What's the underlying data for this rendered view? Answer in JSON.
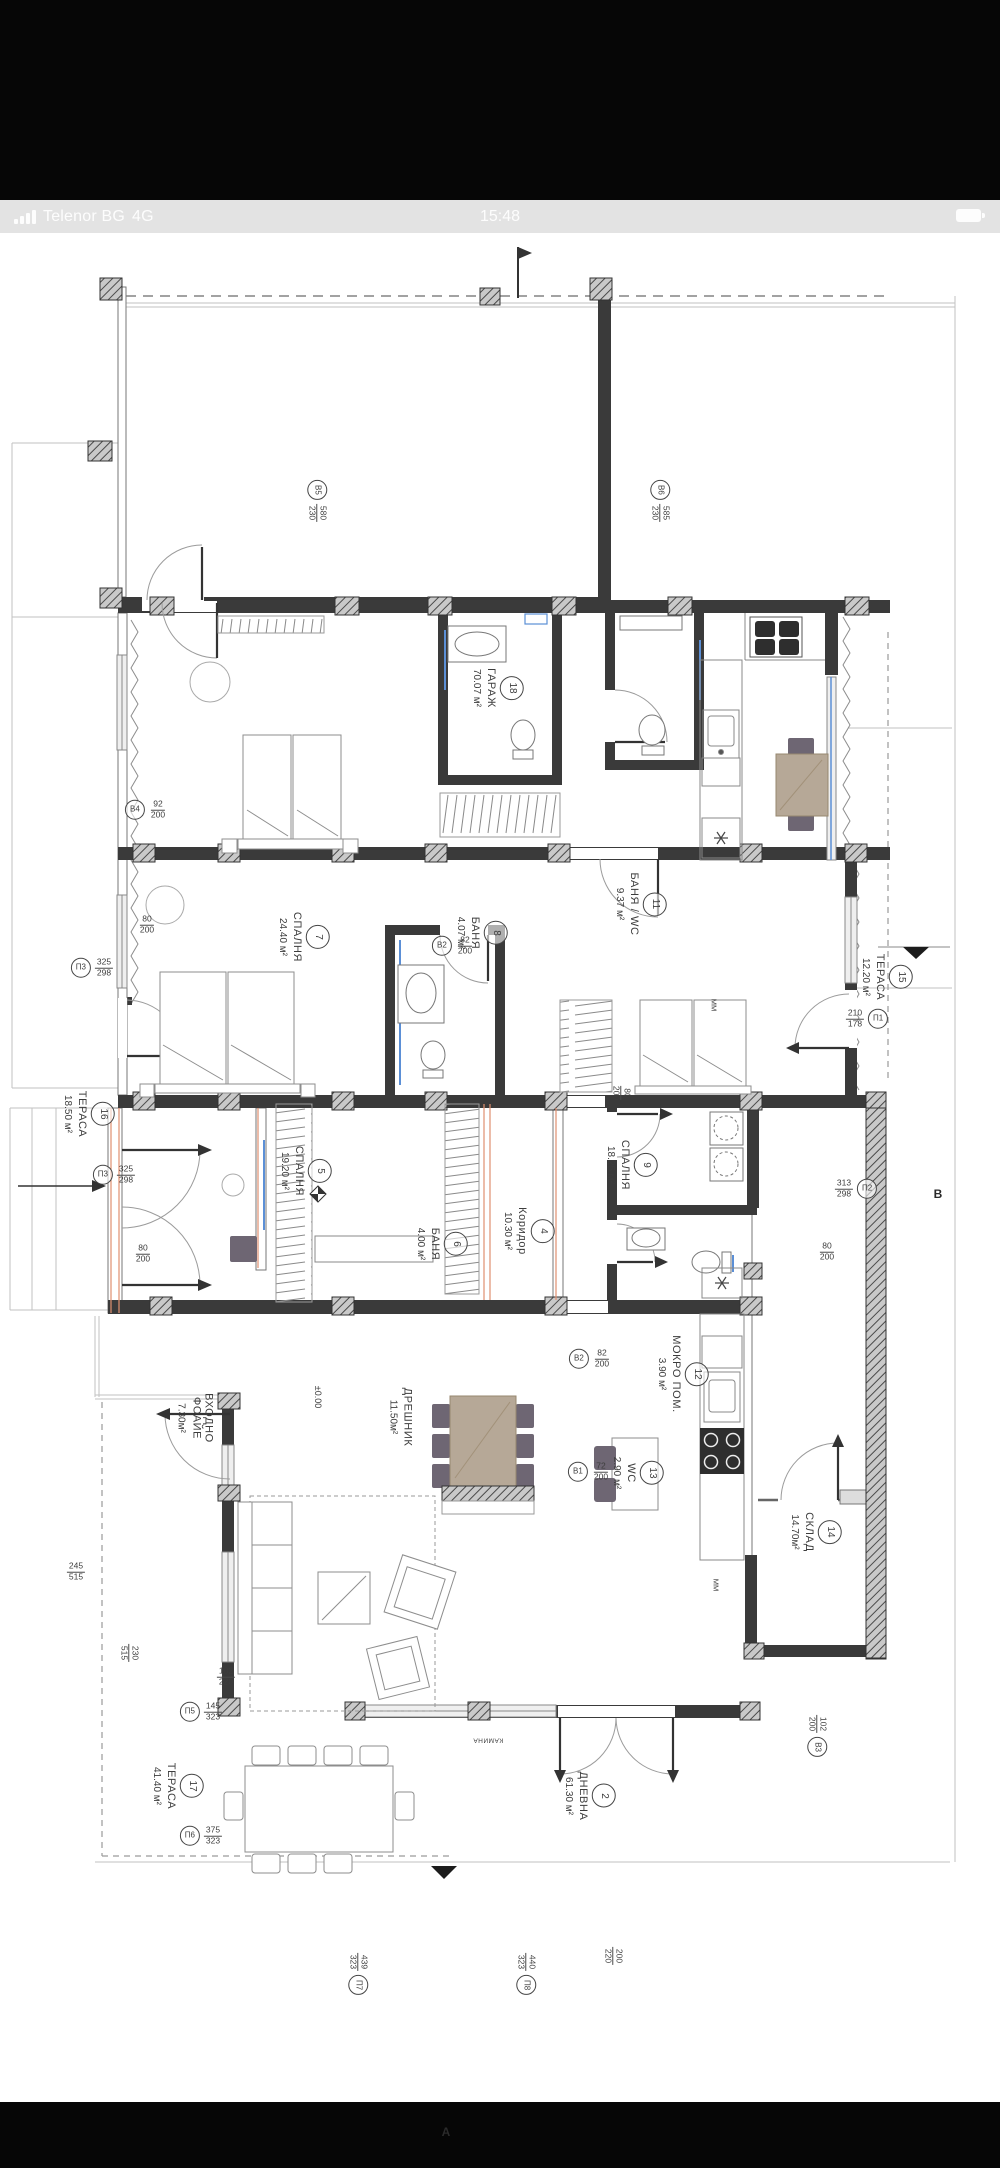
{
  "status_bar": {
    "carrier": "Telenor BG",
    "network": "4G",
    "time": "15:48"
  },
  "plan": {
    "rooms": [
      {
        "num": "18",
        "name": "ГАРАЖ",
        "area": "70.07 м²"
      },
      {
        "num": "7",
        "name": "СПАЛНЯ",
        "area": "24.40 м²"
      },
      {
        "num": "8",
        "name": "БАНЯ",
        "area": "4.07 м²"
      },
      {
        "num": "11",
        "name": "БАНЯ / WC",
        "area": "9.37 м²"
      },
      {
        "num": "15",
        "name": "ТЕРАСА",
        "area": "12.20 м²"
      },
      {
        "num": "16",
        "name": "ТЕРАСА",
        "area": "18.50 м²"
      },
      {
        "num": "5",
        "name": "СПАЛНЯ",
        "area": "19.20 м²"
      },
      {
        "num": "6",
        "name": "БАНЯ",
        "area": "4.00 м²"
      },
      {
        "num": "4",
        "name": "Коридор",
        "area": "10.30 м²"
      },
      {
        "num": "9",
        "name": "СПАЛНЯ",
        "area": "18.25 м²"
      },
      {
        "num": "",
        "name": "ВХОДНО ФОАЙЕ",
        "area": "7.30м²"
      },
      {
        "num": "",
        "name": "ДРЕШНИК",
        "area": "11.50м²"
      },
      {
        "num": "12",
        "name": "МОКРО ПОМ.",
        "area": "3.90 м²"
      },
      {
        "num": "13",
        "name": "WC",
        "area": "2.90 м²"
      },
      {
        "num": "14",
        "name": "СКЛАД",
        "area": "14.70м²"
      },
      {
        "num": "2",
        "name": "ДНЕВНА",
        "area": "61.30 м²"
      },
      {
        "num": "17",
        "name": "ТЕРАСА",
        "area": "41.40 м²"
      }
    ],
    "openings": [
      {
        "tag": "В5",
        "w": "580",
        "h": "230"
      },
      {
        "tag": "В6",
        "w": "585",
        "h": "230"
      },
      {
        "tag": "В4",
        "w": "92",
        "h": "200"
      },
      {
        "tag": "П3",
        "w": "325",
        "h": "298"
      },
      {
        "tag": "В2",
        "w": "82",
        "h": "200"
      },
      {
        "tag": "П1",
        "w": "210",
        "h": "178"
      },
      {
        "tag": "П2",
        "w": "313",
        "h": "298"
      },
      {
        "tag": "П3",
        "w": "325",
        "h": "298"
      },
      {
        "tag": "В2",
        "w": "82",
        "h": "200"
      },
      {
        "tag": "В1",
        "w": "72",
        "h": "200"
      },
      {
        "tag": "В3",
        "w": "102",
        "h": "200"
      },
      {
        "tag": "П5",
        "w": "145",
        "h": "323"
      },
      {
        "tag": "П6",
        "w": "375",
        "h": "323"
      },
      {
        "tag": "П7",
        "w": "439",
        "h": "323"
      },
      {
        "tag": "П8",
        "w": "440",
        "h": "323"
      }
    ],
    "dims": [
      {
        "w": "80",
        "h": "200"
      },
      {
        "w": "80",
        "h": "200"
      },
      {
        "w": "80",
        "h": "200"
      },
      {
        "w": "80",
        "h": "200"
      },
      {
        "w": "245",
        "h": "515"
      },
      {
        "w": "230",
        "h": "515"
      },
      {
        "w": "102",
        "h": "220"
      },
      {
        "w": "200",
        "h": "220"
      }
    ],
    "annotations": {
      "level": "±0.00",
      "fireplace": "КАМИНА",
      "dishwasher": "ММ",
      "section_a": "А",
      "section_b": "В"
    }
  }
}
